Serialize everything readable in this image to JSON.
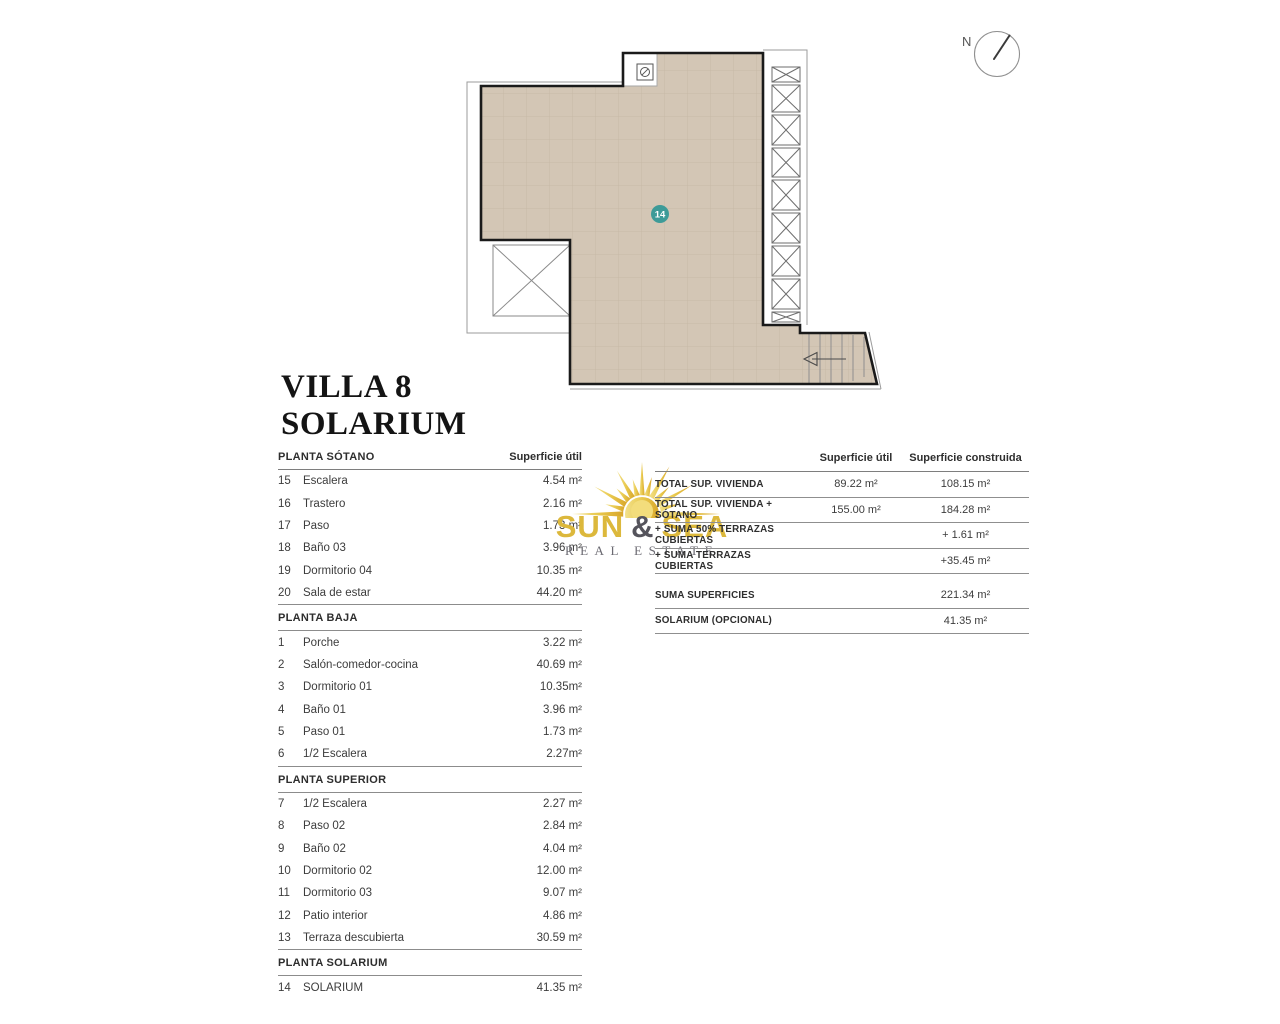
{
  "title": {
    "line1": "VILLA 8",
    "line2": "SOLARIUM"
  },
  "compass": {
    "label": "N"
  },
  "plan": {
    "marker_label": "14"
  },
  "left_table": {
    "col_header": "Superficie útil",
    "sections": [
      {
        "title": "PLANTA SÓTANO",
        "rows": [
          {
            "num": "15",
            "label": "Escalera",
            "value": "4.54 m²"
          },
          {
            "num": "16",
            "label": "Trastero",
            "value": "2.16 m²"
          },
          {
            "num": "17",
            "label": "Paso",
            "value": "1.73 m²"
          },
          {
            "num": "18",
            "label": "Baño 03",
            "value": "3.96 m²"
          },
          {
            "num": "19",
            "label": "Dormitorio 04",
            "value": "10.35 m²"
          },
          {
            "num": "20",
            "label": "Sala de estar",
            "value": "44.20 m²"
          }
        ]
      },
      {
        "title": "PLANTA BAJA",
        "rows": [
          {
            "num": "1",
            "label": "Porche",
            "value": "3.22 m²"
          },
          {
            "num": "2",
            "label": "Salón-comedor-cocina",
            "value": "40.69 m²"
          },
          {
            "num": "3",
            "label": "Dormitorio 01",
            "value": "10.35m²"
          },
          {
            "num": "4",
            "label": "Baño 01",
            "value": "3.96 m²"
          },
          {
            "num": "5",
            "label": "Paso 01",
            "value": "1.73 m²"
          },
          {
            "num": "6",
            "label": "1/2 Escalera",
            "value": "2.27m²"
          }
        ]
      },
      {
        "title": "PLANTA SUPERIOR",
        "rows": [
          {
            "num": "7",
            "label": "1/2 Escalera",
            "value": "2.27 m²"
          },
          {
            "num": "8",
            "label": "Paso 02",
            "value": "2.84 m²"
          },
          {
            "num": "9",
            "label": "Baño 02",
            "value": "4.04 m²"
          },
          {
            "num": "10",
            "label": "Dormitorio 02",
            "value": "12.00 m²"
          },
          {
            "num": "11",
            "label": "Dormitorio 03",
            "value": "9.07 m²"
          },
          {
            "num": "12",
            "label": "Patio interior",
            "value": "4.86 m²"
          },
          {
            "num": "13",
            "label": "Terraza descubierta",
            "value": "30.59 m²"
          }
        ]
      },
      {
        "title": "PLANTA SOLARIUM",
        "rows": [
          {
            "num": "14",
            "label": "SOLARIUM",
            "value": "41.35 m²"
          }
        ]
      }
    ]
  },
  "summary_table": {
    "col_headers": [
      "Superficie útil",
      "Superficie construida"
    ],
    "rows": [
      {
        "label": "TOTAL SUP. VIVIENDA",
        "util": "89.22 m²",
        "construida": "108.15 m²"
      },
      {
        "label": "TOTAL SUP. VIVIENDA + SÓTANO",
        "util": "155.00 m²",
        "construida": "184.28 m²"
      },
      {
        "label": "+ SUMA 50% TERRAZAS CUBIERTAS",
        "util": "",
        "construida": "+ 1.61 m²"
      },
      {
        "label": "+ SUMA TERRAZAS CUBIERTAS",
        "util": "",
        "construida": "+35.45 m²"
      },
      {
        "label": "SUMA SUPERFICIES",
        "util": "",
        "construida": "221.34 m²"
      },
      {
        "label": "SOLARIUM (OPCIONAL)",
        "util": "",
        "construida": "41.35 m²"
      }
    ]
  },
  "logo": {
    "word1": "SUN",
    "amp": "&",
    "word2": "SEA",
    "tagline": "REAL ESTATE"
  },
  "colors": {
    "floor_beige": "#d3c6b5",
    "floor_grid": "#c7b9a7",
    "marker_teal": "#3d9b98",
    "outline_black": "#1a1a1a",
    "thin_gray": "#9b9b9b",
    "logo_gold": "#dcb83c",
    "logo_gray": "#55545c",
    "rule_gray": "#8f8f8f"
  }
}
